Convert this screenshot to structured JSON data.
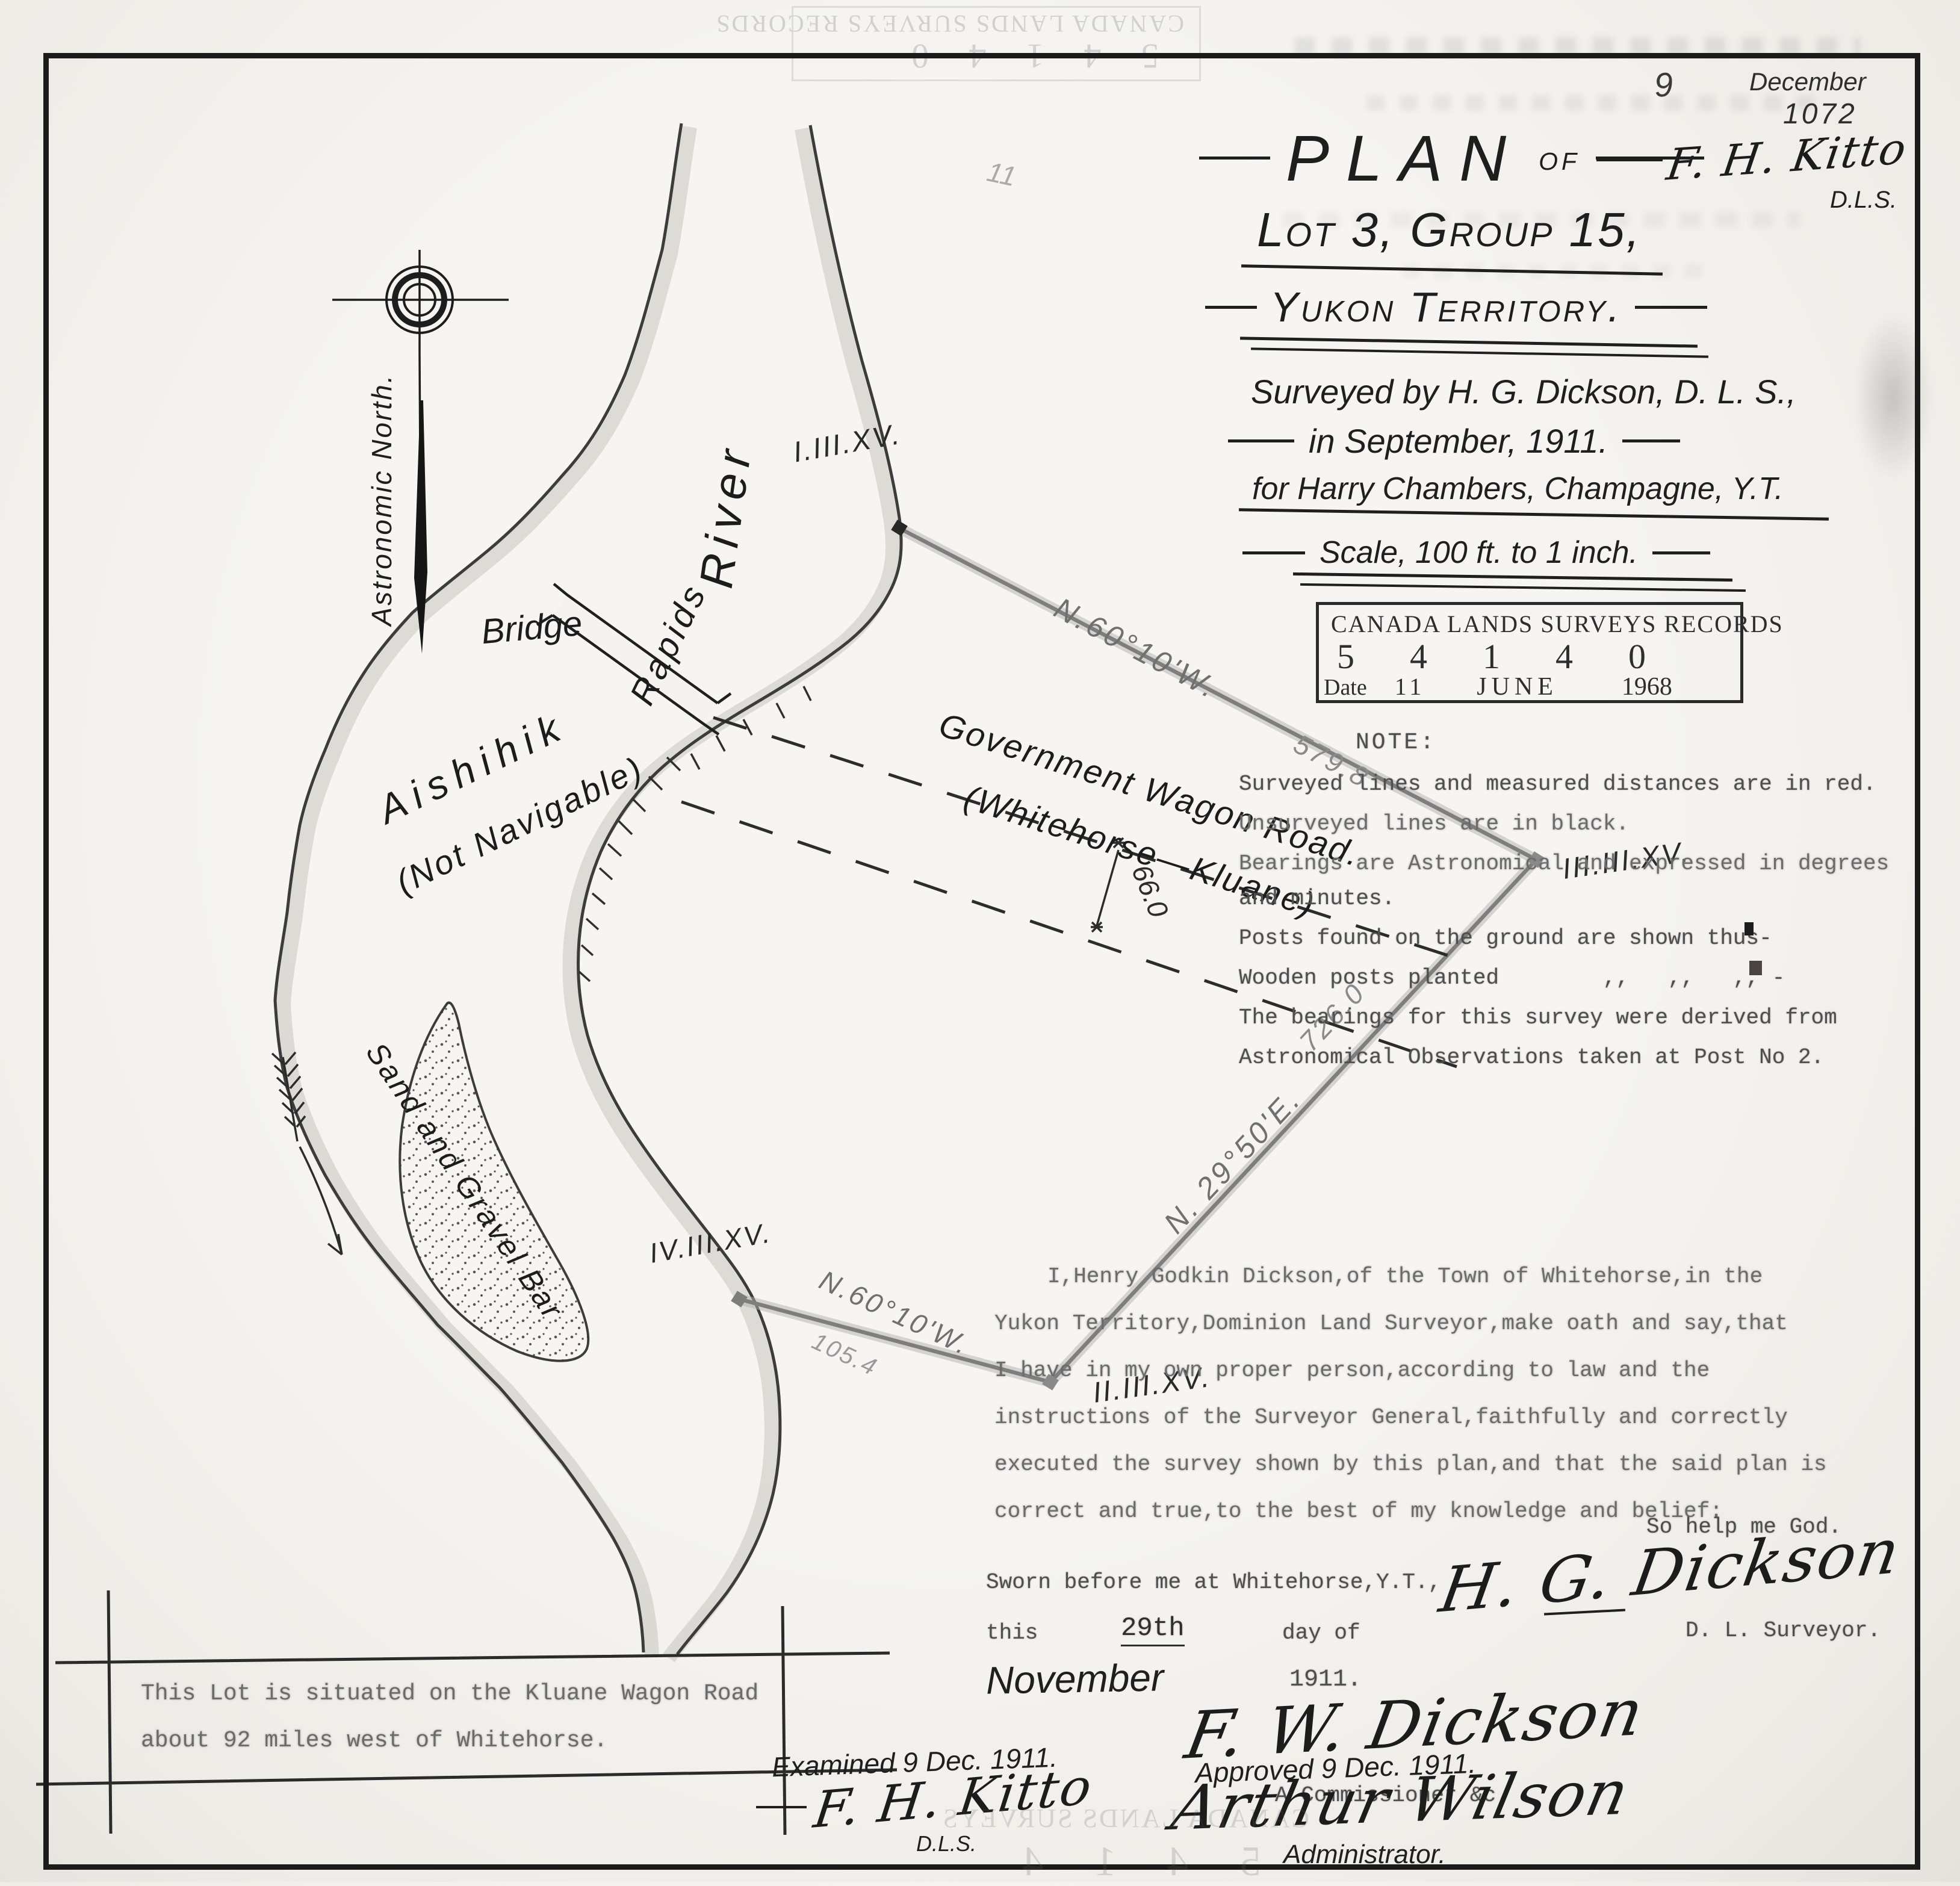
{
  "scan": {
    "ghost_stamp_text": "CANADA LANDS SURVEYS RECORDS",
    "ghost_stamp_text_short": "CANADA LANDS SURVEYS",
    "ghost_stamp_digits": "5 4 1 4 0",
    "ghost_stamp_digits_short": "5 4 1 4"
  },
  "pencil": {
    "number": "9",
    "month": "December",
    "file_number": "1072",
    "tick_marks": "11"
  },
  "kitto_top": {
    "signature": "F. H. Kitto",
    "title": "D.L.S."
  },
  "title_block": {
    "plan": "PLAN",
    "of": "of",
    "lot_line": "Lot 3, Group 15,",
    "territory_line": "Yukon Territory.",
    "surveyed_line": "Surveyed by H. G. Dickson, D. L. S.,",
    "date_line": "in September, 1911.",
    "client_line": "for Harry Chambers, Champagne, Y.T.",
    "scale_line": "Scale, 100 ft. to 1 inch."
  },
  "clsr_stamp": {
    "title": "CANADA LANDS SURVEYS RECORDS",
    "digits": [
      "5",
      "4",
      "1",
      "4",
      "0"
    ],
    "date_label": "Date",
    "day": "11",
    "month": "JUNE",
    "year": "1968"
  },
  "note": {
    "heading": "NOTE:",
    "line1": "Surveyed lines and measured distances are in red.",
    "line2": "Unsurveyed lines are in black.",
    "line3": "Bearings are Astronomical and expressed in degrees",
    "line4": "and minutes.",
    "line5": "Posts found on the ground are shown thus-",
    "line6": "Wooden posts planted        ,,   ,,   ,, -",
    "line7": "The bearings for this survey were derived from",
    "line8": "Astronomical Observations taken at Post No 2."
  },
  "map": {
    "north_label": "Astronomic North.",
    "river_word": "River",
    "river_name": "Aishihik",
    "navigable": "(Not Navigable)",
    "rapids": "Rapids",
    "bridge": "Bridge",
    "sand_bar": "Sand and Gravel Bar",
    "road_line1": "Government Wagon Road.",
    "road_line2": "(Whitehorse—Kluane)",
    "road_width": "66.0",
    "lot_title": "Lot 3, Group 15.",
    "area_label": "Area of Lot,",
    "area_value": "5.17 Ac.",
    "road_label": ",,    ,, Road,",
    "road_value": "0.48",
    "road_suffix": " ,,",
    "total_label": "Total Area,",
    "total_value": "5.65",
    "total_suffix": " ,,",
    "bearing_ne": "N.60°10'W.",
    "dist_ne": "579.8",
    "bearing_e": "N. 29°50'E.",
    "dist_e": "726.0",
    "bearing_s": "N.60°10'W.",
    "dist_s": "105.4",
    "post_1": "I.III.XV.",
    "post_3": "III.III.XV.",
    "post_2": "II.III.XV.",
    "post_4": "IV.III.XV."
  },
  "affidavit": {
    "line1": "I,Henry Godkin Dickson,of the Town of Whitehorse,in the",
    "line2": "Yukon Territory,Dominion Land Surveyor,make oath and say,that",
    "line3": "I have in my own proper person,according to law and the",
    "line4": "instructions of the Surveyor General,faithfully and correctly",
    "line5": "executed the survey shown by this plan,and that the said plan is",
    "line6": "correct and true,to the best of my knowledge and belief:"
  },
  "oath": {
    "so_help": "So help me God.",
    "signature": "H. G. Dickson",
    "title": "D. L. Surveyor."
  },
  "sworn": {
    "line1": "Sworn before me at Whitehorse,Y.T.,",
    "this_word": "this",
    "day": "29th",
    "day_of": "day of",
    "month": "November",
    "year": "1911.",
    "signature": "F. W. Dickson",
    "commissioner": "A Commissioner &c."
  },
  "approval": {
    "examined": "Examined 9 Dec. 1911.",
    "examined_sig": "F. H. Kitto",
    "examined_title": "D.L.S.",
    "approved": "Approved 9 Dec. 1911.",
    "approved_sig": "Arthur Wilson",
    "approved_title": "Administrator."
  },
  "location_note": {
    "line1": "This Lot is situated on the Kluane Wagon Road",
    "line2": "about 92 miles west of Whitehorse."
  }
}
